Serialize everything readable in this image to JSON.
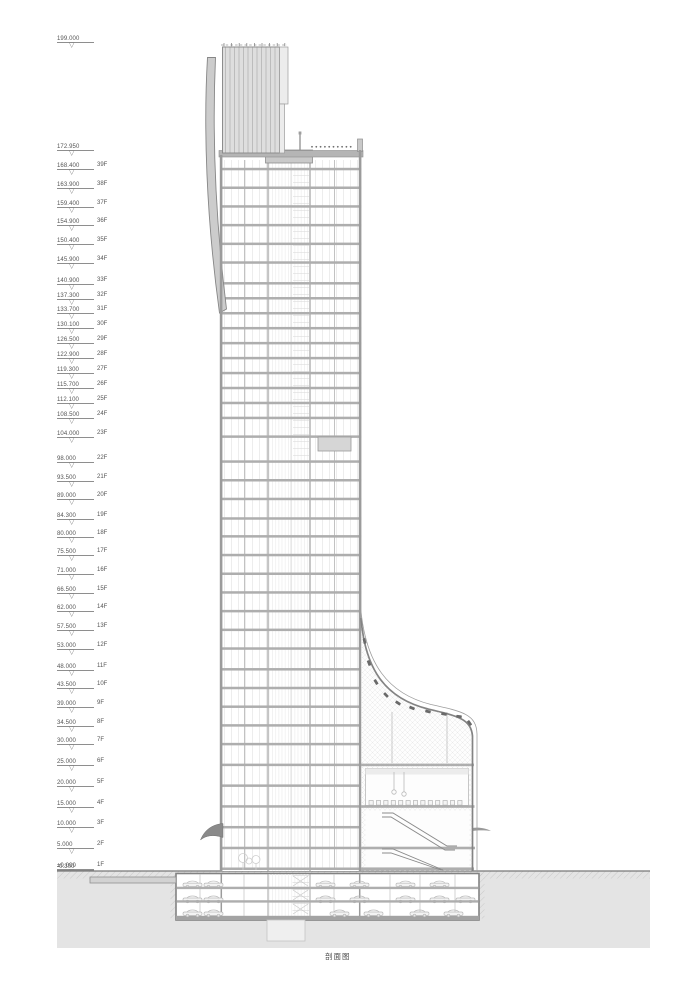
{
  "caption": "剖面图",
  "levels": [
    {
      "elevation": "199.000",
      "value": 199.0,
      "floor": ""
    },
    {
      "elevation": "172.950",
      "value": 172.95,
      "floor": ""
    },
    {
      "elevation": "168.400",
      "value": 168.4,
      "floor": "39F"
    },
    {
      "elevation": "163.900",
      "value": 163.9,
      "floor": "38F"
    },
    {
      "elevation": "159.400",
      "value": 159.4,
      "floor": "37F"
    },
    {
      "elevation": "154.900",
      "value": 154.9,
      "floor": "36F"
    },
    {
      "elevation": "150.400",
      "value": 150.4,
      "floor": "35F"
    },
    {
      "elevation": "145.900",
      "value": 145.9,
      "floor": "34F"
    },
    {
      "elevation": "140.900",
      "value": 140.9,
      "floor": "33F"
    },
    {
      "elevation": "137.300",
      "value": 137.3,
      "floor": "32F"
    },
    {
      "elevation": "133.700",
      "value": 133.7,
      "floor": "31F"
    },
    {
      "elevation": "130.100",
      "value": 130.1,
      "floor": "30F"
    },
    {
      "elevation": "126.500",
      "value": 126.5,
      "floor": "29F"
    },
    {
      "elevation": "122.900",
      "value": 122.9,
      "floor": "28F"
    },
    {
      "elevation": "119.300",
      "value": 119.3,
      "floor": "27F"
    },
    {
      "elevation": "115.700",
      "value": 115.7,
      "floor": "26F"
    },
    {
      "elevation": "112.100",
      "value": 112.1,
      "floor": "25F"
    },
    {
      "elevation": "108.500",
      "value": 108.5,
      "floor": "24F"
    },
    {
      "elevation": "104.000",
      "value": 104.0,
      "floor": "23F"
    },
    {
      "elevation": "98.000",
      "value": 98.0,
      "floor": "22F"
    },
    {
      "elevation": "93.500",
      "value": 93.5,
      "floor": "21F"
    },
    {
      "elevation": "89.000",
      "value": 89.0,
      "floor": "20F"
    },
    {
      "elevation": "84.300",
      "value": 84.3,
      "floor": "19F"
    },
    {
      "elevation": "80.000",
      "value": 80.0,
      "floor": "18F"
    },
    {
      "elevation": "75.500",
      "value": 75.5,
      "floor": "17F"
    },
    {
      "elevation": "71.000",
      "value": 71.0,
      "floor": "16F"
    },
    {
      "elevation": "66.500",
      "value": 66.5,
      "floor": "15F"
    },
    {
      "elevation": "62.000",
      "value": 62.0,
      "floor": "14F"
    },
    {
      "elevation": "57.500",
      "value": 57.5,
      "floor": "13F"
    },
    {
      "elevation": "53.000",
      "value": 53.0,
      "floor": "12F"
    },
    {
      "elevation": "48.000",
      "value": 48.0,
      "floor": "11F"
    },
    {
      "elevation": "43.500",
      "value": 43.5,
      "floor": "10F"
    },
    {
      "elevation": "39.000",
      "value": 39.0,
      "floor": "9F"
    },
    {
      "elevation": "34.500",
      "value": 34.5,
      "floor": "8F"
    },
    {
      "elevation": "30.000",
      "value": 30.0,
      "floor": "7F"
    },
    {
      "elevation": "25.000",
      "value": 25.0,
      "floor": "6F"
    },
    {
      "elevation": "20.000",
      "value": 20.0,
      "floor": "5F"
    },
    {
      "elevation": "15.000",
      "value": 15.0,
      "floor": "4F"
    },
    {
      "elevation": "10.000",
      "value": 10.0,
      "floor": "3F"
    },
    {
      "elevation": "5.000",
      "value": 5.0,
      "floor": "2F"
    },
    {
      "elevation": "±0.000",
      "value": 0.0,
      "floor": "1F"
    },
    {
      "elevation": "-0.300",
      "value": -0.3,
      "floor": ""
    },
    {
      "elevation": "-5.100",
      "value": -5.1,
      "floor": "-1F"
    },
    {
      "elevation": "-8.700",
      "value": -8.7,
      "floor": "-2F"
    },
    {
      "elevation": "-12.600",
      "value": -12.6,
      "floor": "-3F"
    }
  ],
  "level_symbol": "▽",
  "colors": {
    "earth": "#e4e4e4",
    "slab": "#aeaeae",
    "wall": "#9b9b9b",
    "line": "#9a9a9a",
    "dark_detail": "#6a6a6a",
    "text": "#555555"
  }
}
